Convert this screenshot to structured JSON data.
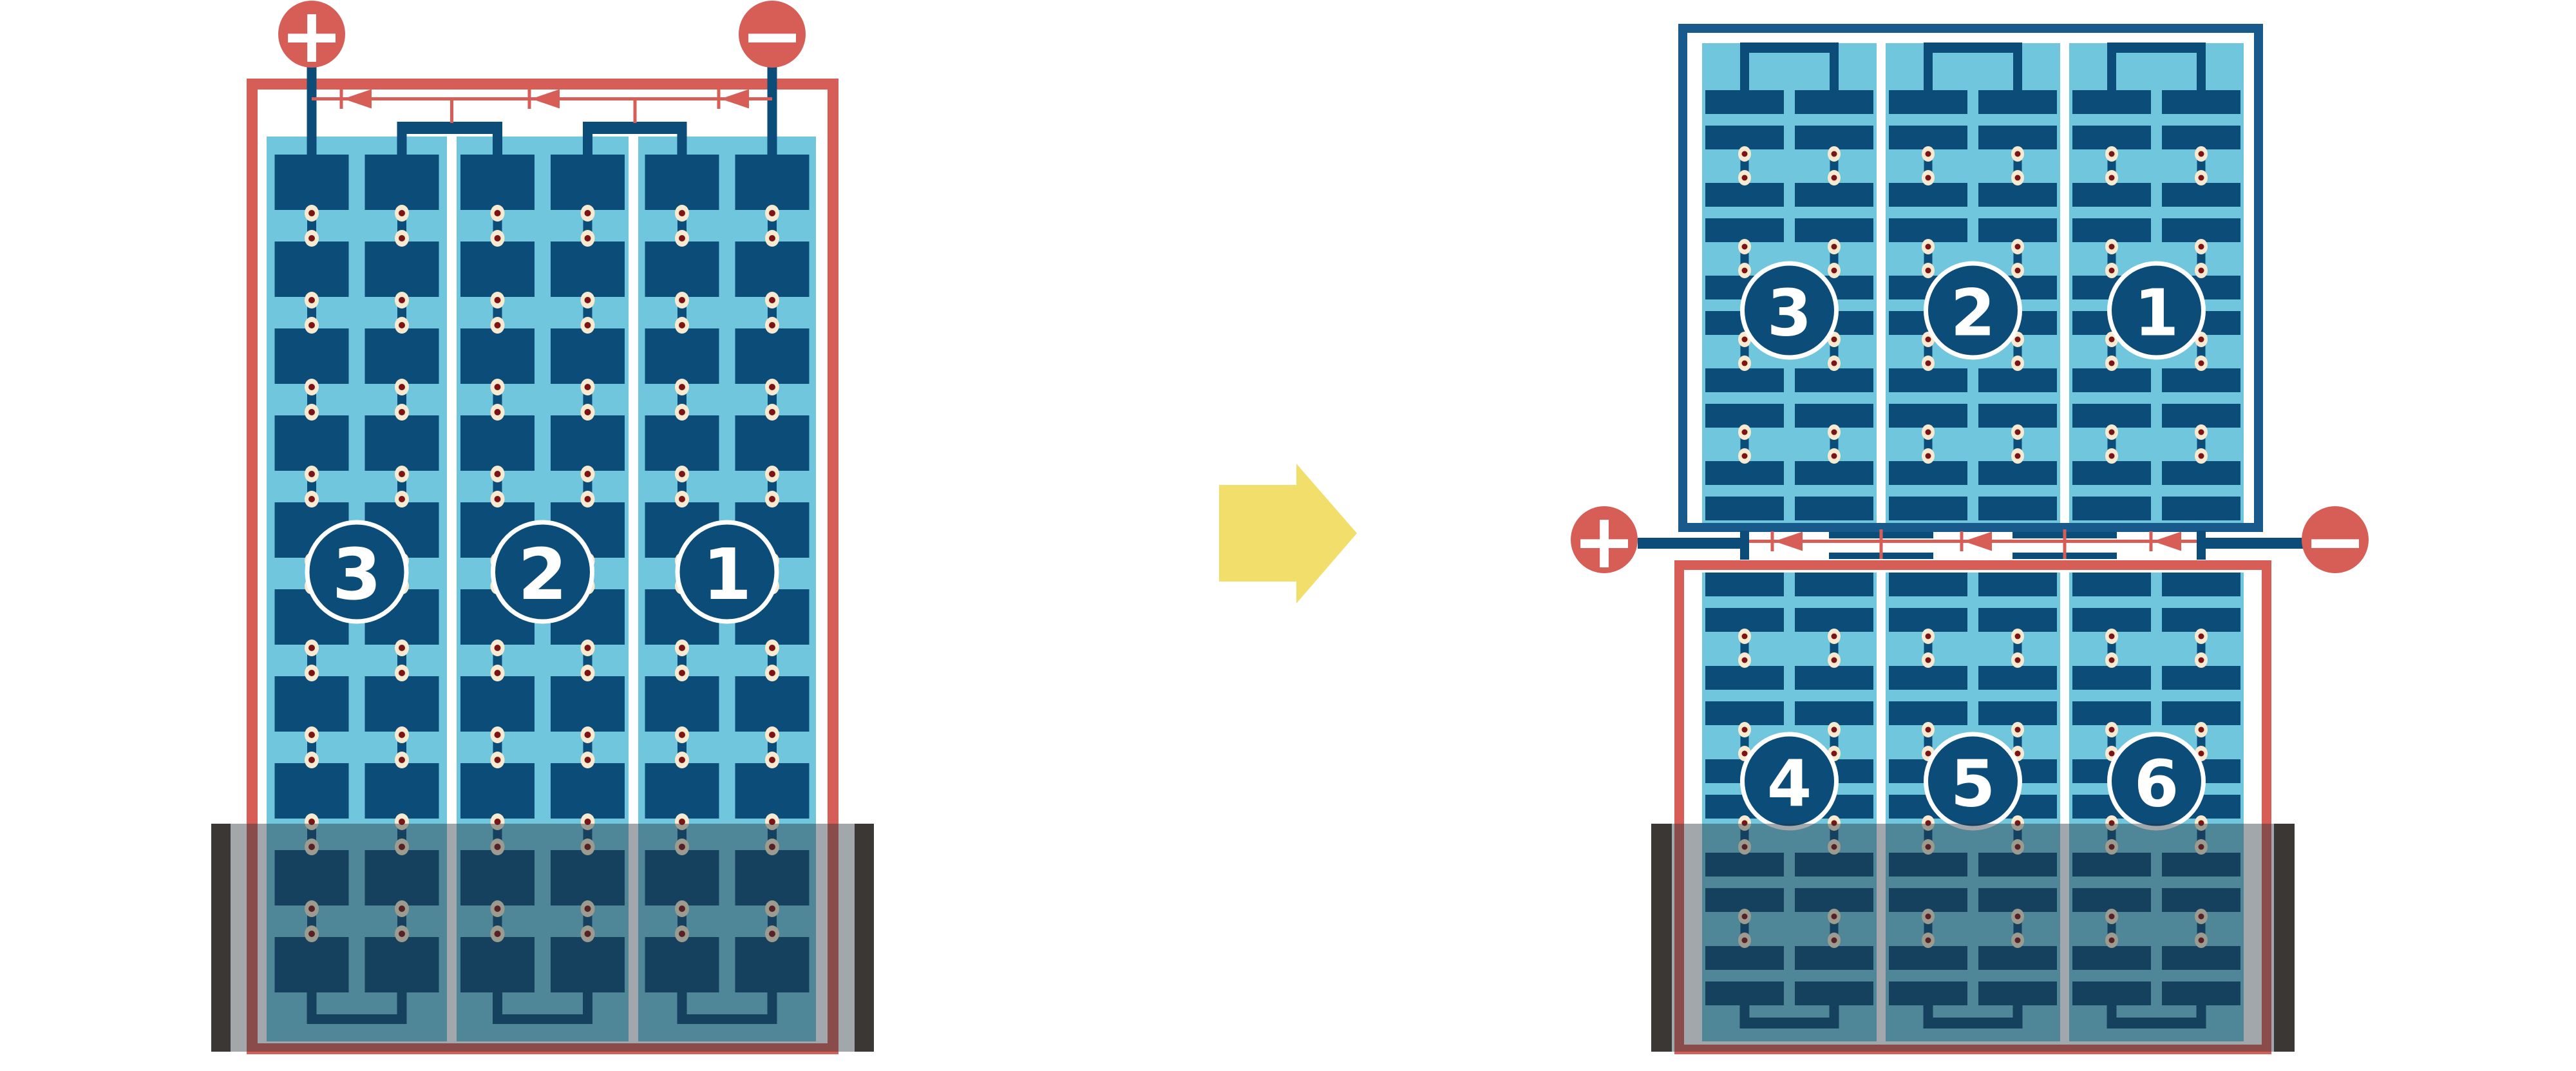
{
  "figure": {
    "type": "solar-module-wiring-diagram",
    "arrow": {
      "direction": "right",
      "color": "#F2DE6A"
    }
  },
  "colors": {
    "red": "#D75E57",
    "cell_dark_blue": "#0B4C78",
    "frame_blue": "#185A8C",
    "light_blue": "#6FC6DD",
    "dot_cream": "#F7EAD0",
    "dot_maroon": "#7D1414",
    "flood_overlay": "rgba(38,52,60,0.43)",
    "black_bar": "#3A3734",
    "white": "#FFFFFF"
  },
  "left_module": {
    "terminals": {
      "positive": "+",
      "negative": "−"
    },
    "strings": [
      {
        "label": "3"
      },
      {
        "label": "2"
      },
      {
        "label": "1"
      }
    ],
    "cell_rows": 10,
    "columns_per_string": 2,
    "bypass_diodes": 3,
    "flooded_bottom": true
  },
  "right_module": {
    "terminals": {
      "positive": "+",
      "negative": "−"
    },
    "bypass_diodes": 3,
    "top_panel": {
      "strings": [
        {
          "label": "3"
        },
        {
          "label": "2"
        },
        {
          "label": "1"
        }
      ],
      "cell_rows": 10,
      "columns_per_string": 2,
      "flooded_bottom": false
    },
    "bottom_panel": {
      "strings": [
        {
          "label": "4"
        },
        {
          "label": "5"
        },
        {
          "label": "6"
        }
      ],
      "cell_rows": 10,
      "columns_per_string": 2,
      "flooded_bottom": true
    }
  }
}
